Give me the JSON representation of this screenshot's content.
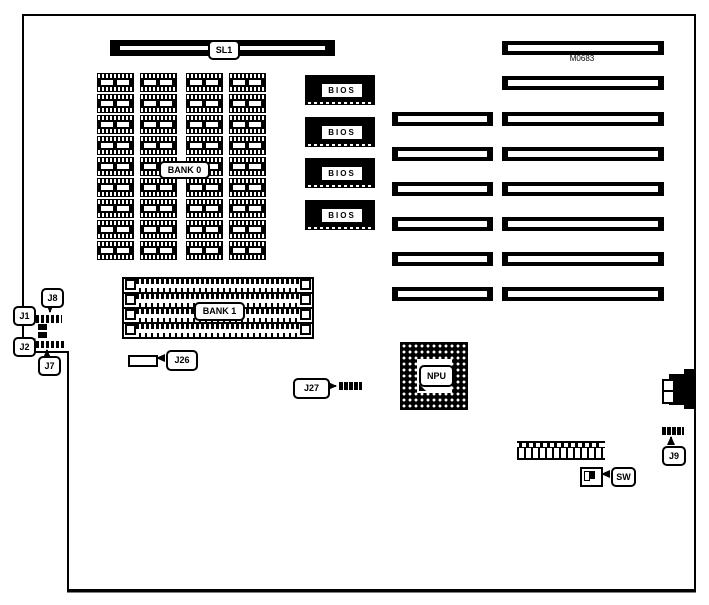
{
  "board": {
    "model": "M0683",
    "cpu_slot": "SL1",
    "bios": "BIOS",
    "bank0": "BANK 0",
    "bank1": "BANK 1",
    "npu": "NPU",
    "switch": "SW",
    "jumpers": {
      "j1": "J1",
      "j2": "J2",
      "j7": "J7",
      "j8": "J8",
      "j9": "J9",
      "j26": "J26",
      "j27": "J27"
    }
  },
  "layout_counts": {
    "bios_chips": 4,
    "dram_rows": 9,
    "dram_cols": 4,
    "simm_sockets": 4,
    "expansion_slots_long": 8,
    "expansion_slots_short": 6
  },
  "colors": {
    "ink": "#000000",
    "paper": "#ffffff"
  }
}
